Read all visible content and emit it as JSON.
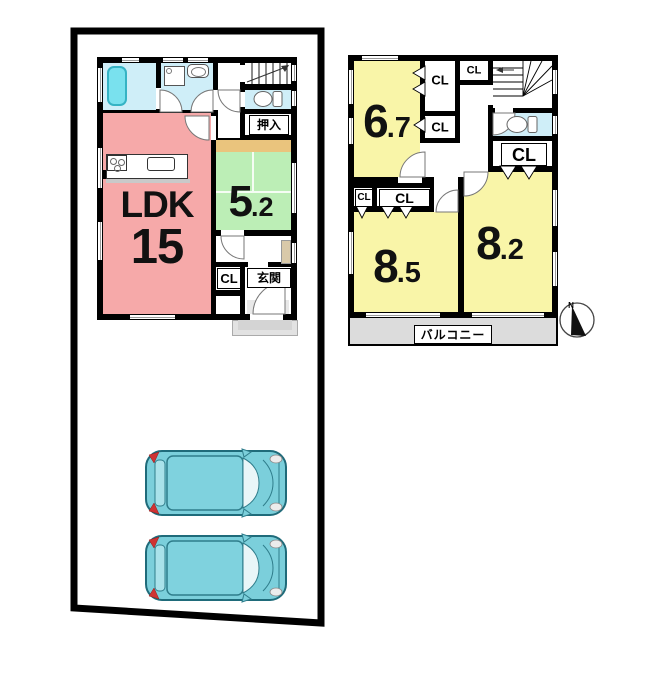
{
  "floor1": {
    "ldk_label": "LDK",
    "ldk_size": "15",
    "tatami_main": "5",
    "tatami_frac": ".2",
    "oshiire_label": "押入",
    "closet_label": "CL",
    "entrance_label": "玄関"
  },
  "floor2": {
    "room1_main": "6",
    "room1_frac": ".7",
    "room2_main": "8",
    "room2_frac": ".5",
    "room3_main": "8",
    "room3_frac": ".2",
    "closet_label": "CL",
    "balcony_label": "バルコニー"
  },
  "compass": {
    "north_label": "N"
  },
  "colors": {
    "wall": "#000000",
    "ldk_pink": "#f6a9a9",
    "tatami_green": "#bceeb6",
    "tatami_edge_tan": "#eac47d",
    "bedroom_yellow": "#f9f5a8",
    "wet_area_blue": "#cfeef8",
    "bathtub_cyan": "#79e1ee",
    "balcony_gray": "#dcdcdc",
    "porch_gray": "#d9d9d9",
    "car_teal": "#7bcfdb",
    "taillight_red": "#cf3333"
  }
}
